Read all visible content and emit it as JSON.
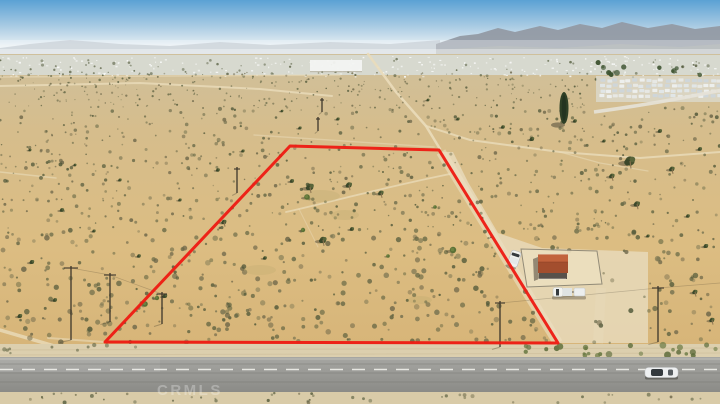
{
  "scene": {
    "type": "aerial-drone-photo",
    "subject": "vacant desert land parcel outlined in red beside a paved highway",
    "watermark": "CRMLS"
  },
  "colors": {
    "sky_top": "#5ba1d4",
    "sky_mid": "#a9cbe3",
    "sky_horizon": "#e9f0f4",
    "mountains_far": "#b7c1c9",
    "mountains_right": "#929aa4",
    "haze": "#ffffff",
    "valley": "#d8ddd8",
    "speck_white": "#fbfcfc",
    "desert_far": "#cfc09c",
    "desert_mid": "#d6bd8c",
    "desert_main": "#dcbd82",
    "desert_near": "#d4b073",
    "trail": "#eadcba",
    "apron": "#e6d7b5",
    "shoulder": "#dccfae",
    "shoulder_bottom": "#d9cba8",
    "road_top": "#a6a6a2",
    "road_bottom": "#8b8b87",
    "road_line": "#f4f4ee",
    "boundary": "#ee1a12",
    "roof_top": "#c2633c",
    "roof_front": "#a34e2e",
    "wall": "#58514b",
    "fence": "#8a8472",
    "enclosure_fill": "#ecdfbf",
    "bush_dark_1": "#6b6548",
    "bush_dark_2": "#565c3d",
    "bush_dark_3": "#73704f",
    "bush_dark_4": "#4f5738",
    "tree_dark": "#46512e",
    "tree_green": "#5a7036",
    "tree_shadow": "#4f4936",
    "pole": "#3c362b",
    "vehicle_white": "#f1f2ef",
    "glass": "#343a3e",
    "watermark_color": "#ffffff"
  },
  "boundary": {
    "points": [
      [
        290,
        146
      ],
      [
        439,
        150
      ],
      [
        558,
        343
      ],
      [
        105,
        342
      ]
    ],
    "stroke_width": 3
  },
  "apron": {
    "points": [
      [
        441,
        152
      ],
      [
        453,
        152
      ],
      [
        468,
        182
      ],
      [
        498,
        233
      ],
      [
        542,
        248
      ],
      [
        648,
        252
      ],
      [
        648,
        343
      ],
      [
        558,
        343
      ]
    ]
  },
  "trails": [
    {
      "d": "M0,86 L140,83 L260,89 L332,96",
      "w": 2,
      "o": 0.8
    },
    {
      "d": "M0,77 L340,75",
      "w": 1.5,
      "o": 0.6
    },
    {
      "d": "M368,54 L396,92 L426,126 L440,149",
      "w": 2.5,
      "o": 0.9
    },
    {
      "d": "M426,126 L470,140 L560,152 L640,158 L720,152",
      "w": 2,
      "o": 0.8
    },
    {
      "d": "M560,152 L600,163 L648,171",
      "w": 1.2,
      "o": 0.55
    },
    {
      "d": "M254,135 L434,147",
      "w": 1.4,
      "o": 0.5
    },
    {
      "d": "M286,212 C330,202 390,186 450,174",
      "w": 1.8,
      "o": 0.75
    },
    {
      "d": "M299,209 L318,247",
      "w": 1,
      "o": 0.45
    },
    {
      "d": "M0,172 L56,178",
      "w": 1.5,
      "o": 0.6
    },
    {
      "d": "M0,330 L92,357",
      "w": 3.5,
      "o": 0.8
    },
    {
      "d": "M48,338 L104,342",
      "w": 2,
      "o": 0.6
    },
    {
      "d": "M30,357 Q80,349 150,346",
      "w": 1.2,
      "o": 0.6
    },
    {
      "d": "M0,352 Q60,348 120,345",
      "w": 1.2,
      "o": 0.5
    }
  ],
  "green_patches": [
    {
      "x": 320,
      "y": 196,
      "rx": 20,
      "ry": 6
    },
    {
      "x": 345,
      "y": 215,
      "rx": 14,
      "ry": 5
    },
    {
      "x": 260,
      "y": 270,
      "rx": 16,
      "ry": 5
    },
    {
      "x": 420,
      "y": 300,
      "rx": 12,
      "ry": 4
    }
  ],
  "trees": [
    {
      "x": 310,
      "y": 187,
      "r": 4,
      "t": "j"
    },
    {
      "x": 349,
      "y": 185,
      "r": 3.2,
      "t": "j"
    },
    {
      "x": 381,
      "y": 193,
      "r": 2.8,
      "t": "j"
    },
    {
      "x": 323,
      "y": 240,
      "r": 3.8,
      "t": "j"
    },
    {
      "x": 352,
      "y": 229,
      "r": 2.2,
      "t": "j"
    },
    {
      "x": 292,
      "y": 181,
      "r": 2.2,
      "t": "j"
    },
    {
      "x": 224,
      "y": 222,
      "r": 2.6,
      "t": "j"
    },
    {
      "x": 265,
      "y": 258,
      "r": 2,
      "t": "j"
    },
    {
      "x": 165,
      "y": 296,
      "r": 2.4,
      "t": "j"
    },
    {
      "x": 307,
      "y": 197,
      "r": 2.8,
      "t": "g"
    },
    {
      "x": 303,
      "y": 230,
      "r": 2.2,
      "t": "g"
    },
    {
      "x": 453,
      "y": 250,
      "r": 3.2,
      "t": "g"
    },
    {
      "x": 145,
      "y": 304,
      "r": 2.8,
      "t": "g"
    },
    {
      "x": 157,
      "y": 298,
      "r": 2.2,
      "t": "g"
    },
    {
      "x": 435,
      "y": 207,
      "r": 1.8,
      "t": "g"
    },
    {
      "x": 388,
      "y": 256,
      "r": 1.8,
      "t": "g"
    },
    {
      "x": 630,
      "y": 161,
      "r": 5.5,
      "t": "j"
    },
    {
      "x": 612,
      "y": 176,
      "r": 2.8,
      "t": "j"
    },
    {
      "x": 672,
      "y": 169,
      "r": 2.8,
      "t": "j"
    },
    {
      "x": 637,
      "y": 204,
      "r": 3.2,
      "t": "j"
    },
    {
      "x": 700,
      "y": 149,
      "r": 2.2,
      "t": "j"
    },
    {
      "x": 660,
      "y": 131,
      "r": 2.2,
      "t": "j"
    },
    {
      "x": 604,
      "y": 141,
      "r": 1.8,
      "t": "j"
    },
    {
      "x": 688,
      "y": 216,
      "r": 2,
      "t": "j"
    },
    {
      "x": 648,
      "y": 236,
      "r": 1.8,
      "t": "j"
    },
    {
      "x": 706,
      "y": 246,
      "r": 2.4,
      "t": "j"
    },
    {
      "x": 695,
      "y": 292,
      "r": 2.6,
      "t": "j"
    },
    {
      "x": 712,
      "y": 320,
      "r": 2.6,
      "t": "j"
    },
    {
      "x": 300,
      "y": 128,
      "r": 1.8,
      "t": "j"
    },
    {
      "x": 338,
      "y": 119,
      "r": 1.8,
      "t": "j"
    },
    {
      "x": 282,
      "y": 111,
      "r": 1.5,
      "t": "j"
    },
    {
      "x": 428,
      "y": 100,
      "r": 1.6,
      "t": "j"
    },
    {
      "x": 458,
      "y": 119,
      "r": 1.8,
      "t": "j"
    },
    {
      "x": 503,
      "y": 127,
      "r": 2,
      "t": "j"
    },
    {
      "x": 532,
      "y": 139,
      "r": 2.4,
      "t": "j"
    },
    {
      "x": 575,
      "y": 121,
      "r": 2,
      "t": "j"
    },
    {
      "x": 243,
      "y": 151,
      "r": 1.8,
      "t": "j"
    },
    {
      "x": 218,
      "y": 170,
      "r": 2,
      "t": "j"
    },
    {
      "x": 62,
      "y": 210,
      "r": 2.2,
      "t": "j"
    },
    {
      "x": 94,
      "y": 231,
      "r": 1.8,
      "t": "j"
    },
    {
      "x": 32,
      "y": 262,
      "r": 2.4,
      "t": "j"
    },
    {
      "x": 139,
      "y": 256,
      "r": 2,
      "t": "j"
    },
    {
      "x": 55,
      "y": 300,
      "r": 2.2,
      "t": "j"
    },
    {
      "x": 20,
      "y": 316,
      "r": 2.4,
      "t": "j"
    },
    {
      "x": 120,
      "y": 180,
      "r": 1.8,
      "t": "j"
    },
    {
      "x": 75,
      "y": 165,
      "r": 1.6,
      "t": "j"
    },
    {
      "x": 30,
      "y": 150,
      "r": 1.6,
      "t": "j"
    },
    {
      "x": 180,
      "y": 200,
      "r": 1.8,
      "t": "j"
    }
  ],
  "tower_tree": {
    "x": 564,
    "y": 108
  },
  "poles": [
    {
      "x": 71,
      "y1": 266,
      "y2": 340,
      "a": 7
    },
    {
      "x": 110,
      "y1": 273,
      "y2": 322,
      "a": 6
    },
    {
      "x": 162,
      "y1": 292,
      "y2": 324,
      "a": 5
    },
    {
      "x": 237,
      "y1": 167,
      "y2": 193,
      "a": 3
    },
    {
      "x": 322,
      "y1": 98,
      "y2": 112,
      "a": 2
    },
    {
      "x": 318,
      "y1": 117,
      "y2": 131,
      "a": 2
    },
    {
      "x": 500,
      "y1": 301,
      "y2": 347,
      "a": 5
    },
    {
      "x": 658,
      "y1": 286,
      "y2": 342,
      "a": 6
    }
  ],
  "wires": [
    "M71,268 L110,275 L162,294",
    "M500,303 L658,288 L720,283"
  ],
  "enclosure": {
    "d": "M521,249 L597,251 L602,284 L527,287 Z"
  },
  "building": {
    "x": 538,
    "y": 254,
    "w": 30,
    "roof_top_h": 8,
    "roof_front_h": 11,
    "wall_h": 8
  },
  "vehicles": {
    "van": {
      "x": 509,
      "y": 251,
      "w": 10,
      "h": 16,
      "rot": 18,
      "cx": 515,
      "cy": 260
    },
    "pickup": {
      "x": 553,
      "y": 287.5
    },
    "car": {
      "x": 645,
      "y": 367.5,
      "w": 33,
      "h": 10
    }
  },
  "warehouse": {
    "x": 310,
    "y": 60,
    "w": 52,
    "h": 11
  },
  "housing": {
    "x0": 600,
    "x1": 718,
    "y0": 79,
    "rows": 4,
    "row_gap": 5.2,
    "col_gap": 6.5,
    "base": {
      "x": 596,
      "y": 76,
      "w": 124,
      "h": 26
    }
  },
  "housing_road": {
    "d": "M594,112 Q660,103 722,90"
  },
  "road": {
    "y": 357,
    "h": 35,
    "dash_y": 369.5,
    "dash": "13 9",
    "edge_y": 359
  },
  "speckles": {
    "seed": 1337,
    "farN": 380,
    "midN": 650,
    "nearN": 520,
    "valleyWhiteN": 260,
    "valleyGreenN": 90,
    "weedsN": 46,
    "shrubN": 26,
    "tractTreeN": 14
  }
}
